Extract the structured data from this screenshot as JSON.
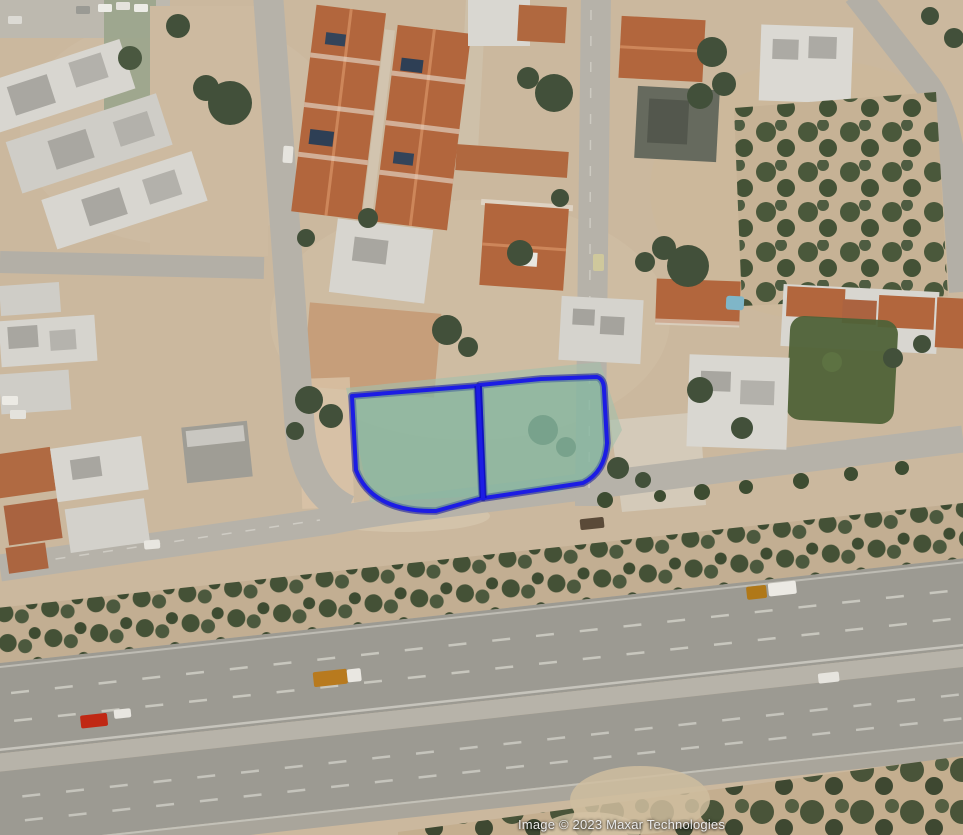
{
  "map": {
    "type": "satellite-imagery",
    "attribution": "Image © 2023 Maxar Technologies",
    "annotation": {
      "parcel_fill": "#74b29a",
      "parcel_fill_opacity": "0.5",
      "parcel_stroke": "#1c1ce4",
      "parcel_stroke_dark": "#000299",
      "parcels": [
        {
          "id": "parcel-west",
          "path": "M352,396 L477,386 L482,498 L436,511 Q372,512 356,470 Z"
        },
        {
          "id": "parcel-east",
          "path": "M480,385 L541,379 L597,377 Q604,379 604,390 L607,443 Q605,472 583,483 L484,498 Z"
        }
      ],
      "divider_path": "M478,386 L483,498"
    },
    "palette": {
      "ground": "#cbb89e",
      "road": "#b6b2a9",
      "highway_asphalt": "#9c9a92",
      "median": "#b7b3a9",
      "hedge_soil": "#c2ae92",
      "scrub_soil": "#c4ae8f",
      "terracotta_roof": "#b2663d",
      "white_building": "#d8d6d0",
      "tree": "#42503a",
      "lawn": "#4f6238",
      "red_car": "#c02814",
      "truck_orange": "#b87a1e"
    }
  }
}
